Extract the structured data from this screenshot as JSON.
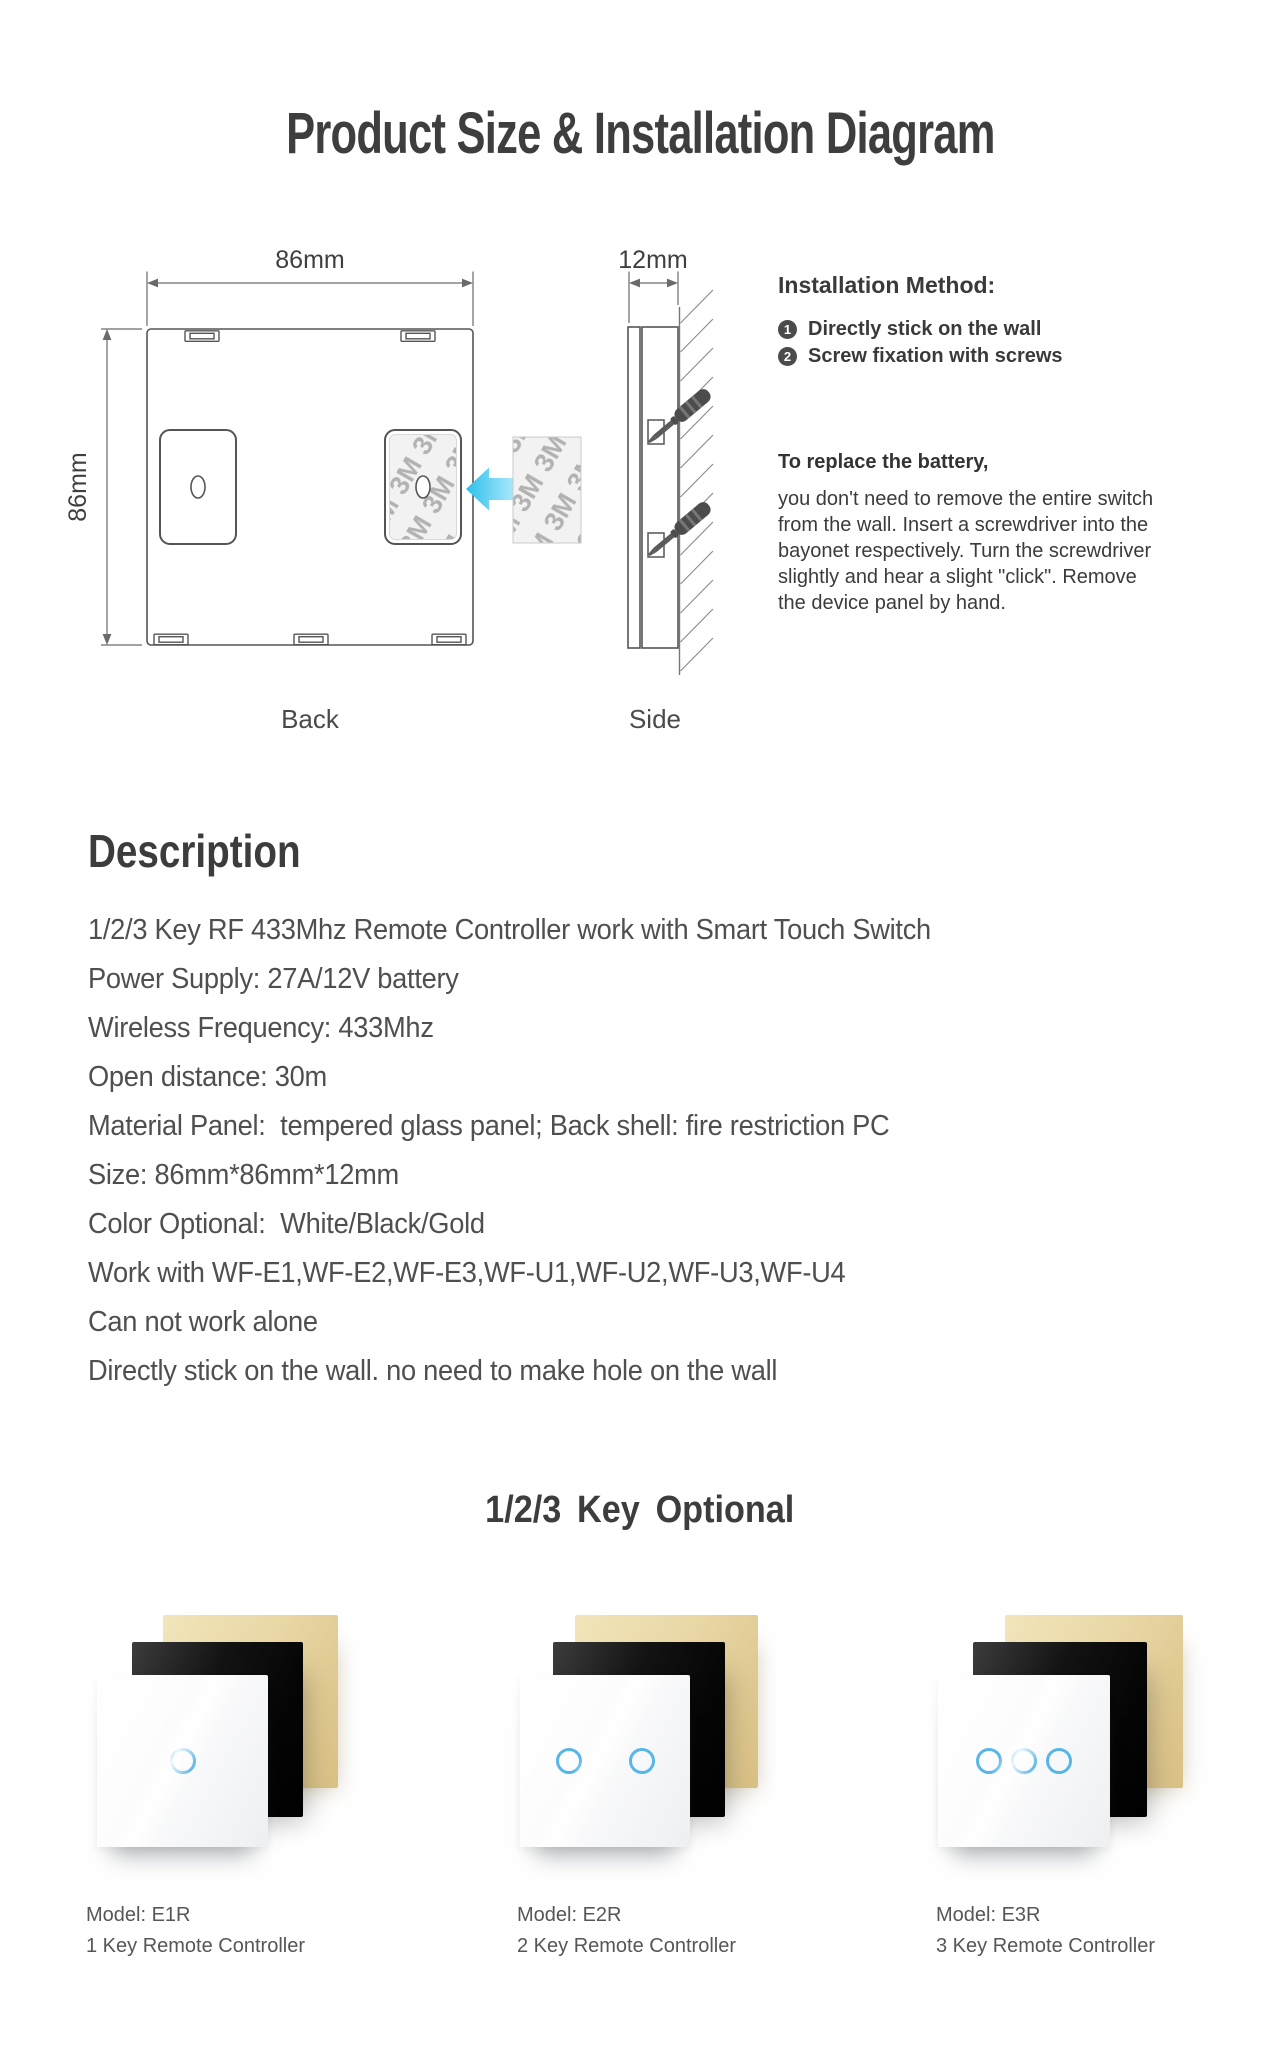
{
  "page": {
    "title": "Product Size & Installation Diagram"
  },
  "diagram": {
    "back": {
      "label": "Back",
      "width_dim": "86mm",
      "height_dim": "86mm"
    },
    "side": {
      "label": "Side",
      "width_dim": "12mm"
    },
    "sticker_text": "3M",
    "installation": {
      "heading": "Installation Method:",
      "items": [
        {
          "num": "1",
          "text": "Directly stick on the wall"
        },
        {
          "num": "2",
          "text": "Screw fixation with screws"
        }
      ],
      "battery": {
        "heading": "To replace the battery,",
        "lines": [
          "you don't need to remove the entire switch",
          "from the wall. Insert a screwdriver into the",
          "bayonet respectively. Turn the screwdriver",
          "slightly and hear a slight \"click\". Remove",
          "the device panel by hand."
        ]
      }
    }
  },
  "description": {
    "heading": "Description",
    "lines": [
      "1/2/3 Key RF 433Mhz Remote Controller work with Smart Touch Switch",
      "Power Supply: 27A/12V battery",
      "Wireless Frequency: 433Mhz",
      "Open distance: 30m",
      "Material Panel:  tempered glass panel; Back shell: fire restriction PC",
      "Size: 86mm*86mm*12mm",
      "Color Optional:  White/Black/Gold",
      "Work with WF-E1,WF-E2,WF-E3,WF-U1,WF-U2,WF-U3,WF-U4",
      "Can not work alone",
      "Directly stick on the wall. no need to make hole on the wall"
    ]
  },
  "options": {
    "heading": "1/2/3 Key Optional",
    "products": [
      {
        "model": "Model: E1R",
        "name": "1 Key Remote Controller",
        "keys": 1
      },
      {
        "model": "Model: E2R",
        "name": "2 Key Remote Controller",
        "keys": 2
      },
      {
        "model": "Model: E3R",
        "name": "3 Key Remote Controller",
        "keys": 3
      }
    ],
    "colors": {
      "touch_ring": "#58b5e8",
      "arrow_cyan": "#3fc5f0",
      "panel_gold": "#e9d7a6",
      "panel_black": "#131313",
      "panel_white": "#fcfcfd",
      "heading_text": "#3d3d3d",
      "body_text": "#4f4f4f"
    }
  }
}
